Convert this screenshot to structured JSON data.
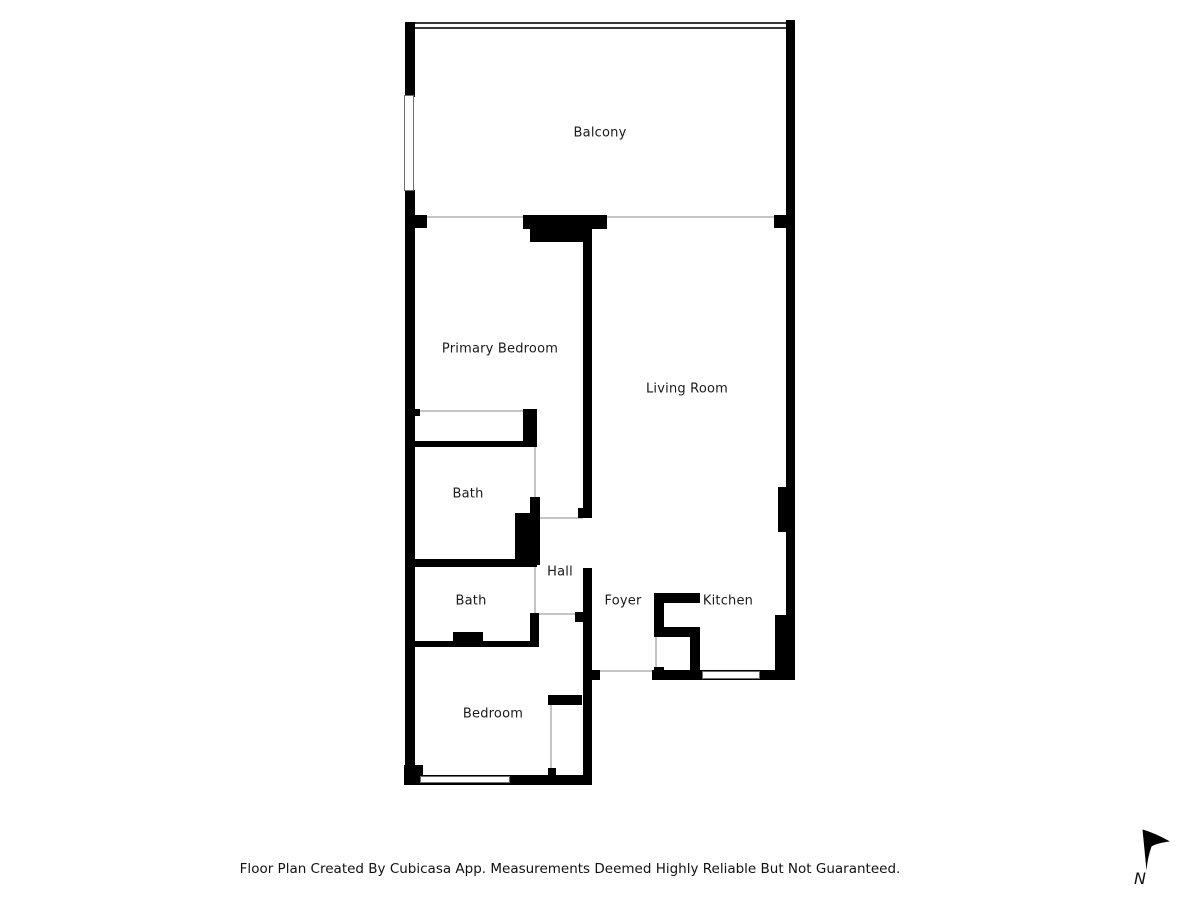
{
  "title": "Floor Plan",
  "rooms": {
    "balcony": {
      "label": "Balcony"
    },
    "primary_bedroom": {
      "label": "Primary Bedroom"
    },
    "living_room": {
      "label": "Living Room"
    },
    "bath_upper": {
      "label": "Bath"
    },
    "bath_lower": {
      "label": "Bath"
    },
    "hall": {
      "label": "Hall"
    },
    "foyer": {
      "label": "Foyer"
    },
    "kitchen": {
      "label": "Kitchen"
    },
    "bedroom": {
      "label": "Bedroom"
    }
  },
  "footer": {
    "disclaimer": "Floor Plan Created By Cubicasa App. Measurements Deemed Highly Reliable But Not Guaranteed."
  },
  "compass": {
    "label": "N"
  },
  "colors": {
    "wall": "#000000",
    "background": "#ffffff",
    "label_text": "#1a1a1a",
    "opening_line": "#c4c4c4",
    "window_line": "#6e6e6e"
  }
}
